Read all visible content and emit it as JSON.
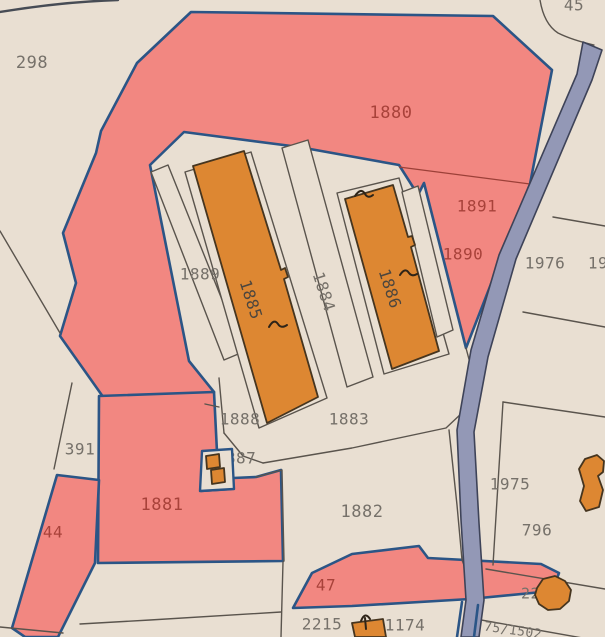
{
  "map": {
    "type": "cadastral-parcel-map",
    "palette": {
      "background": "#e9dfd2",
      "parcel_fill": "#e9dfd2",
      "highlight_fill": "#f28781",
      "highlight_border": "#2b5586",
      "parcel_border": "#5a544d",
      "building_fill": "#dd8732",
      "building_border": "#46351f",
      "road_fill": "#9398b6",
      "road_border": "#3e4358",
      "label_gray": "#76716a",
      "label_red": "#a8423a",
      "label_dark": "#4c463e",
      "inner_red_line": "#9c4038"
    },
    "labels": [
      {
        "id": "298",
        "text": "298",
        "x": 32,
        "y": 63,
        "color": "gray",
        "size": 17
      },
      {
        "id": "45",
        "text": "45",
        "x": 574,
        "y": 6,
        "color": "gray",
        "size": 16
      },
      {
        "id": "1880",
        "text": "1880",
        "x": 391,
        "y": 113,
        "color": "red",
        "size": 17
      },
      {
        "id": "1891",
        "text": "1891",
        "x": 477,
        "y": 207,
        "color": "red",
        "size": 16
      },
      {
        "id": "1890",
        "text": "1890",
        "x": 463,
        "y": 255,
        "color": "red",
        "size": 16
      },
      {
        "id": "1976",
        "text": "1976",
        "x": 545,
        "y": 264,
        "color": "gray",
        "size": 16
      },
      {
        "id": "19-clipped",
        "text": "19",
        "x": 598,
        "y": 264,
        "color": "gray",
        "size": 16
      },
      {
        "id": "1889",
        "text": "1889",
        "x": 200,
        "y": 275,
        "color": "gray",
        "size": 16
      },
      {
        "id": "1885",
        "text": "1885",
        "x": 250,
        "y": 300,
        "color": "dark",
        "size": 16,
        "rot": 72
      },
      {
        "id": "1884",
        "text": "1884",
        "x": 323,
        "y": 292,
        "color": "gray",
        "size": 16,
        "rot": 72
      },
      {
        "id": "1886",
        "text": "1886",
        "x": 389,
        "y": 289,
        "color": "dark",
        "size": 16,
        "rot": 72
      },
      {
        "id": "1888",
        "text": "1888",
        "x": 240,
        "y": 420,
        "color": "gray",
        "size": 16
      },
      {
        "id": "1883",
        "text": "1883",
        "x": 349,
        "y": 420,
        "color": "gray",
        "size": 16
      },
      {
        "id": "391",
        "text": "391",
        "x": 80,
        "y": 450,
        "color": "gray",
        "size": 16
      },
      {
        "id": "1887",
        "text": "1887",
        "x": 236,
        "y": 459,
        "color": "gray",
        "size": 16,
        "layer": "under"
      },
      {
        "id": "1881",
        "text": "1881",
        "x": 162,
        "y": 505,
        "color": "red",
        "size": 17
      },
      {
        "id": "44",
        "text": "44",
        "x": 53,
        "y": 533,
        "color": "red",
        "size": 16
      },
      {
        "id": "1882",
        "text": "1882",
        "x": 362,
        "y": 512,
        "color": "gray",
        "size": 17
      },
      {
        "id": "1975",
        "text": "1975",
        "x": 510,
        "y": 485,
        "color": "gray",
        "size": 16
      },
      {
        "id": "796",
        "text": "796",
        "x": 537,
        "y": 531,
        "color": "gray",
        "size": 16
      },
      {
        "id": "47",
        "text": "47",
        "x": 326,
        "y": 586,
        "color": "red",
        "size": 16
      },
      {
        "id": "2215",
        "text": "2215",
        "x": 322,
        "y": 625,
        "color": "gray",
        "size": 16
      },
      {
        "id": "1174",
        "text": "1174",
        "x": 405,
        "y": 626,
        "color": "gray",
        "size": 16
      },
      {
        "id": "2253",
        "text": "2253",
        "x": 540,
        "y": 594,
        "color": "gray",
        "size": 15,
        "layer": "under"
      },
      {
        "id": "75-1502",
        "text": "75/1502",
        "x": 513,
        "y": 631,
        "color": "gray",
        "size": 13,
        "rot": 8
      }
    ]
  }
}
